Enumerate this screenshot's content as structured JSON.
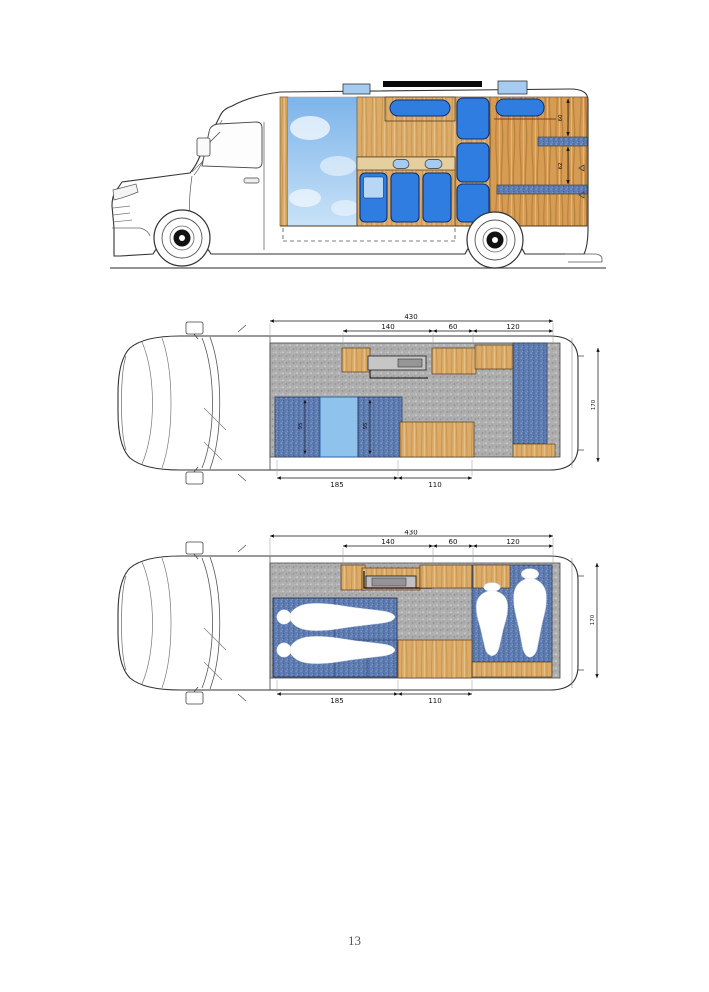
{
  "page_number": "13",
  "side_view": {
    "dim_upper": "60",
    "dim_lower": "62"
  },
  "floor_plan": {
    "dim_total": "430",
    "dim_seg1": "140",
    "dim_seg2": "60",
    "dim_seg3": "120",
    "dim_bottom1": "185",
    "dim_bottom2": "110",
    "dim_width": "170",
    "dim_bench1": "95",
    "dim_bench2": "95"
  },
  "bed_plan": {
    "dim_total": "430",
    "dim_seg1": "140",
    "dim_seg2": "60",
    "dim_seg3": "120",
    "dim_bottom1": "185",
    "dim_bottom2": "110",
    "dim_width": "170"
  },
  "colors": {
    "furniture_blue": "#2f7de1",
    "light_blue": "#a5cbf1",
    "wood": "#dcab67",
    "denim_blue": "#5e7cb1",
    "floor_gray": "#aeaeae",
    "sky_blue": "#7db4ea",
    "table_blue": "#8fc3ee"
  }
}
